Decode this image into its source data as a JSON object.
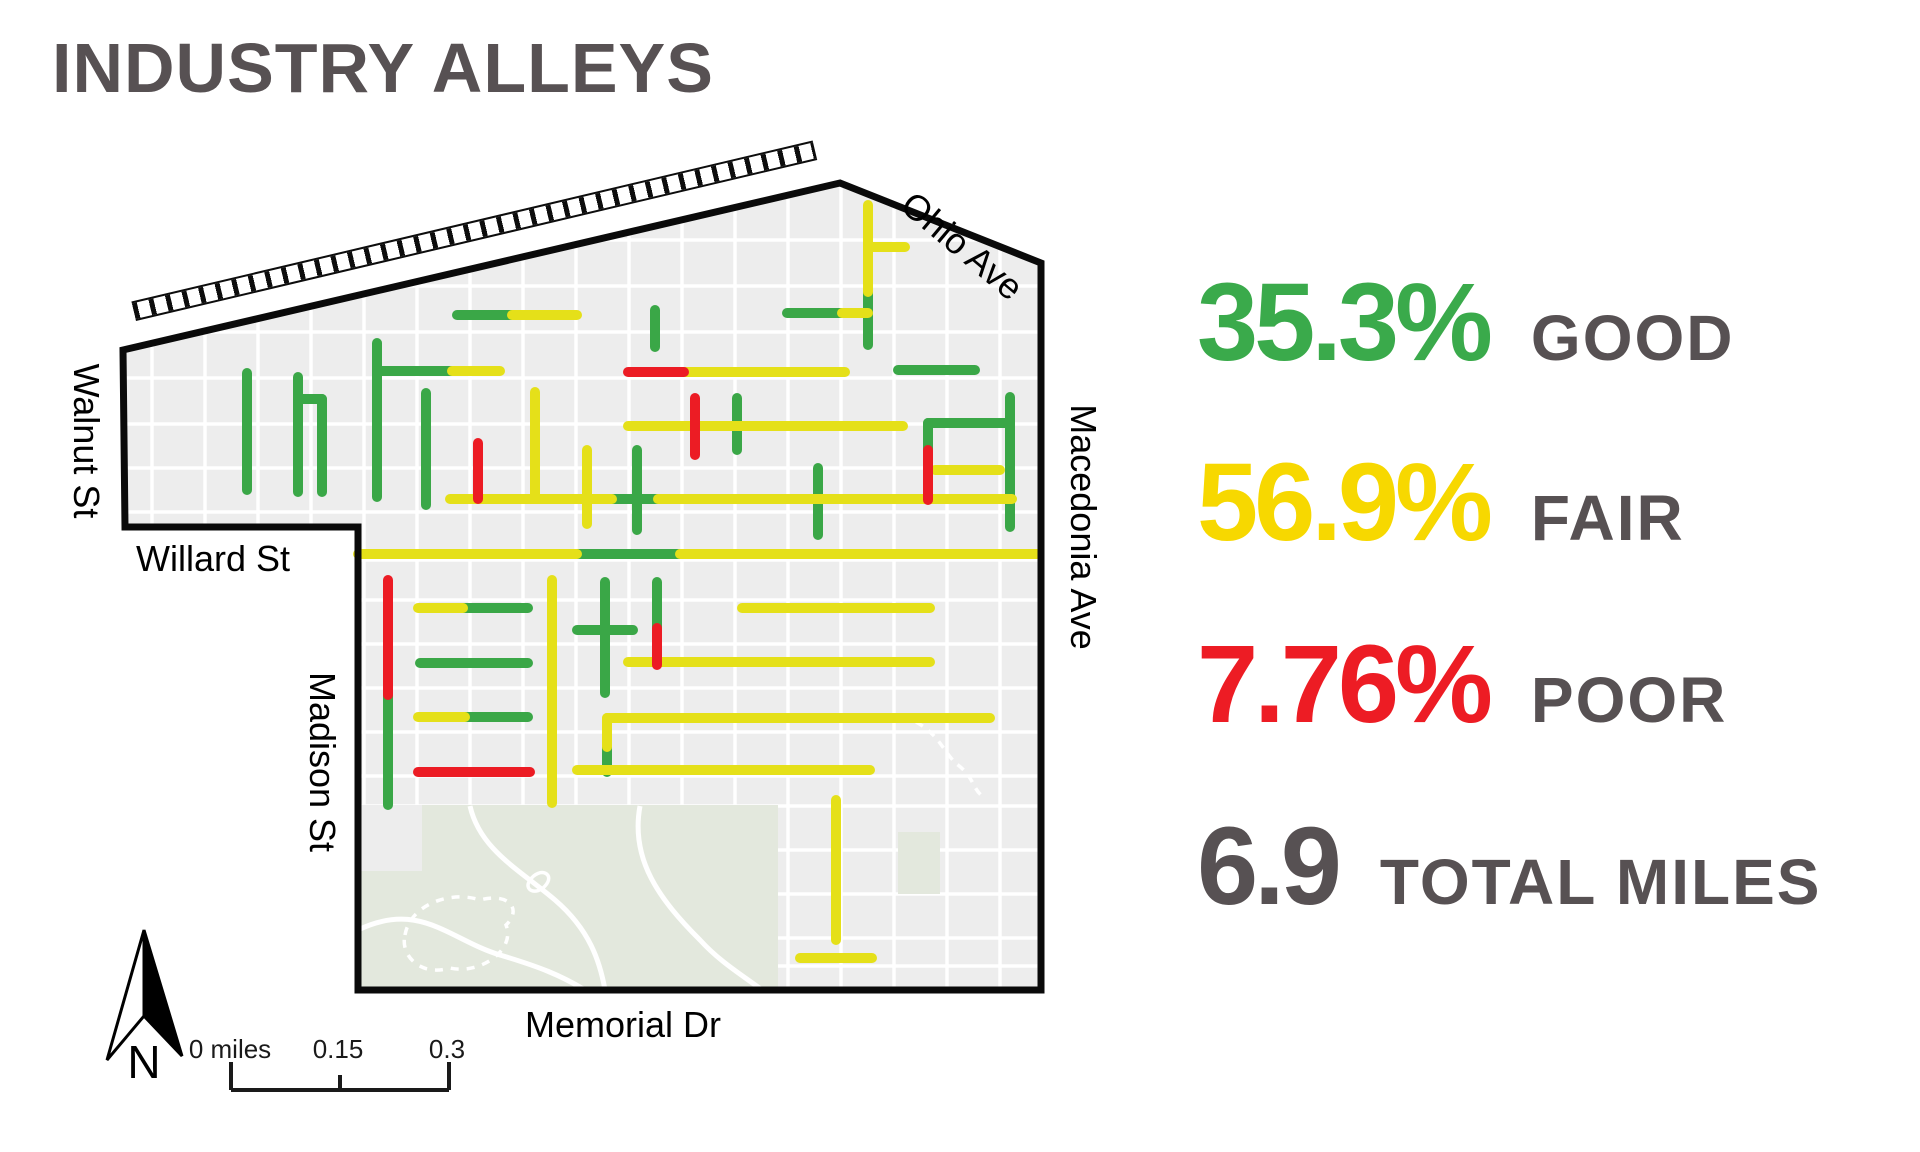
{
  "title": "INDUSTRY ALLEYS",
  "stats": [
    {
      "value": "35.3%",
      "label": "GOOD",
      "color": "#3aaa4b"
    },
    {
      "value": "56.9%",
      "label": "FAIR",
      "color": "#f7d800"
    },
    {
      "value": "7.76%",
      "label": "POOR",
      "color": "#ed1c24"
    },
    {
      "value": "6.9",
      "label": "TOTAL MILES",
      "color": "#575153"
    }
  ],
  "map": {
    "street_labels": {
      "ohio": "Ohio Ave",
      "walnut": "Walnut St",
      "willard": "Willard St",
      "madison": "Madison St",
      "macedonia": "Macedonia Ave",
      "memorial": "Memorial Dr"
    },
    "north_label": "N",
    "scale_bar": {
      "labels": [
        "0 miles",
        "0.15",
        "0.3"
      ]
    },
    "condition_colors": {
      "good": "#3aa747",
      "fair": "#e5e019",
      "poor": "#ec1c24"
    },
    "alleys": [
      {
        "condition": "good",
        "points": [
          [
            247,
            373
          ],
          [
            247,
            490
          ]
        ]
      },
      {
        "condition": "good",
        "points": [
          [
            298,
            377
          ],
          [
            298,
            492
          ]
        ]
      },
      {
        "condition": "good",
        "points": [
          [
            298,
            399
          ],
          [
            322,
            399
          ]
        ]
      },
      {
        "condition": "good",
        "points": [
          [
            322,
            399
          ],
          [
            322,
            492
          ]
        ]
      },
      {
        "condition": "good",
        "points": [
          [
            377,
            343
          ],
          [
            377,
            497
          ]
        ]
      },
      {
        "condition": "good",
        "points": [
          [
            377,
            371
          ],
          [
            452,
            371
          ]
        ]
      },
      {
        "condition": "good",
        "points": [
          [
            426,
            393
          ],
          [
            426,
            505
          ]
        ]
      },
      {
        "condition": "good",
        "points": [
          [
            457,
            315
          ],
          [
            512,
            315
          ]
        ]
      },
      {
        "condition": "good",
        "points": [
          [
            655,
            310
          ],
          [
            655,
            347
          ]
        ]
      },
      {
        "condition": "good",
        "points": [
          [
            898,
            370
          ],
          [
            975,
            370
          ]
        ]
      },
      {
        "condition": "good",
        "points": [
          [
            737,
            398
          ],
          [
            737,
            450
          ]
        ]
      },
      {
        "condition": "good",
        "points": [
          [
            868,
            292
          ],
          [
            868,
            345
          ]
        ]
      },
      {
        "condition": "good",
        "points": [
          [
            787,
            313
          ],
          [
            842,
            313
          ]
        ]
      },
      {
        "condition": "good",
        "points": [
          [
            612,
            499
          ],
          [
            658,
            499
          ]
        ]
      },
      {
        "condition": "good",
        "points": [
          [
            637,
            450
          ],
          [
            637,
            530
          ]
        ]
      },
      {
        "condition": "good",
        "points": [
          [
            818,
            468
          ],
          [
            818,
            535
          ]
        ]
      },
      {
        "condition": "good",
        "points": [
          [
            1010,
            397
          ],
          [
            1010,
            527
          ]
        ]
      },
      {
        "condition": "good",
        "points": [
          [
            928,
            423
          ],
          [
            1010,
            423
          ]
        ]
      },
      {
        "condition": "good",
        "points": [
          [
            928,
            423
          ],
          [
            928,
            450
          ]
        ]
      },
      {
        "condition": "good",
        "points": [
          [
            577,
            554
          ],
          [
            680,
            554
          ]
        ]
      },
      {
        "condition": "good",
        "points": [
          [
            388,
            695
          ],
          [
            388,
            805
          ]
        ]
      },
      {
        "condition": "good",
        "points": [
          [
            463,
            608
          ],
          [
            528,
            608
          ]
        ]
      },
      {
        "condition": "good",
        "points": [
          [
            420,
            663
          ],
          [
            528,
            663
          ]
        ]
      },
      {
        "condition": "good",
        "points": [
          [
            465,
            717
          ],
          [
            528,
            717
          ]
        ]
      },
      {
        "condition": "good",
        "points": [
          [
            605,
            582
          ],
          [
            605,
            693
          ]
        ]
      },
      {
        "condition": "good",
        "points": [
          [
            577,
            630
          ],
          [
            633,
            630
          ]
        ]
      },
      {
        "condition": "good",
        "points": [
          [
            657,
            582
          ],
          [
            657,
            628
          ]
        ]
      },
      {
        "condition": "good",
        "points": [
          [
            607,
            747
          ],
          [
            607,
            772
          ]
        ]
      },
      {
        "condition": "fair",
        "points": [
          [
            452,
            371
          ],
          [
            500,
            371
          ]
        ]
      },
      {
        "condition": "fair",
        "points": [
          [
            512,
            315
          ],
          [
            577,
            315
          ]
        ]
      },
      {
        "condition": "fair",
        "points": [
          [
            535,
            392
          ],
          [
            535,
            499
          ]
        ]
      },
      {
        "condition": "fair",
        "points": [
          [
            587,
            450
          ],
          [
            587,
            524
          ]
        ]
      },
      {
        "condition": "fair",
        "points": [
          [
            684,
            372
          ],
          [
            845,
            372
          ]
        ]
      },
      {
        "condition": "fair",
        "points": [
          [
            628,
            426
          ],
          [
            903,
            426
          ]
        ]
      },
      {
        "condition": "fair",
        "points": [
          [
            868,
            205
          ],
          [
            868,
            292
          ]
        ]
      },
      {
        "condition": "fair",
        "points": [
          [
            868,
            247
          ],
          [
            905,
            247
          ]
        ]
      },
      {
        "condition": "fair",
        "points": [
          [
            842,
            313
          ],
          [
            868,
            313
          ]
        ]
      },
      {
        "condition": "fair",
        "points": [
          [
            450,
            499
          ],
          [
            612,
            499
          ]
        ]
      },
      {
        "condition": "fair",
        "points": [
          [
            658,
            499
          ],
          [
            1012,
            499
          ]
        ]
      },
      {
        "condition": "fair",
        "points": [
          [
            935,
            470
          ],
          [
            1000,
            470
          ]
        ]
      },
      {
        "condition": "fair",
        "points": [
          [
            358,
            554
          ],
          [
            577,
            554
          ]
        ]
      },
      {
        "condition": "fair",
        "points": [
          [
            680,
            554
          ],
          [
            1037,
            554
          ]
        ]
      },
      {
        "condition": "fair",
        "points": [
          [
            418,
            608
          ],
          [
            463,
            608
          ]
        ]
      },
      {
        "condition": "fair",
        "points": [
          [
            418,
            717
          ],
          [
            465,
            717
          ]
        ]
      },
      {
        "condition": "fair",
        "points": [
          [
            552,
            580
          ],
          [
            552,
            803
          ]
        ]
      },
      {
        "condition": "fair",
        "points": [
          [
            742,
            608
          ],
          [
            930,
            608
          ]
        ]
      },
      {
        "condition": "fair",
        "points": [
          [
            628,
            662
          ],
          [
            930,
            662
          ]
        ]
      },
      {
        "condition": "fair",
        "points": [
          [
            607,
            718
          ],
          [
            990,
            718
          ]
        ]
      },
      {
        "condition": "fair",
        "points": [
          [
            607,
            718
          ],
          [
            607,
            747
          ]
        ]
      },
      {
        "condition": "fair",
        "points": [
          [
            577,
            770
          ],
          [
            870,
            770
          ]
        ]
      },
      {
        "condition": "fair",
        "points": [
          [
            836,
            800
          ],
          [
            836,
            940
          ]
        ]
      },
      {
        "condition": "fair",
        "points": [
          [
            800,
            958
          ],
          [
            872,
            958
          ]
        ]
      },
      {
        "condition": "poor",
        "points": [
          [
            478,
            443
          ],
          [
            478,
            499
          ]
        ]
      },
      {
        "condition": "poor",
        "points": [
          [
            628,
            372
          ],
          [
            684,
            372
          ]
        ]
      },
      {
        "condition": "poor",
        "points": [
          [
            695,
            398
          ],
          [
            695,
            455
          ]
        ]
      },
      {
        "condition": "poor",
        "points": [
          [
            928,
            450
          ],
          [
            928,
            500
          ]
        ]
      },
      {
        "condition": "poor",
        "points": [
          [
            388,
            580
          ],
          [
            388,
            695
          ]
        ]
      },
      {
        "condition": "poor",
        "points": [
          [
            418,
            772
          ],
          [
            530,
            772
          ]
        ]
      },
      {
        "condition": "poor",
        "points": [
          [
            657,
            628
          ],
          [
            657,
            665
          ]
        ]
      }
    ]
  }
}
